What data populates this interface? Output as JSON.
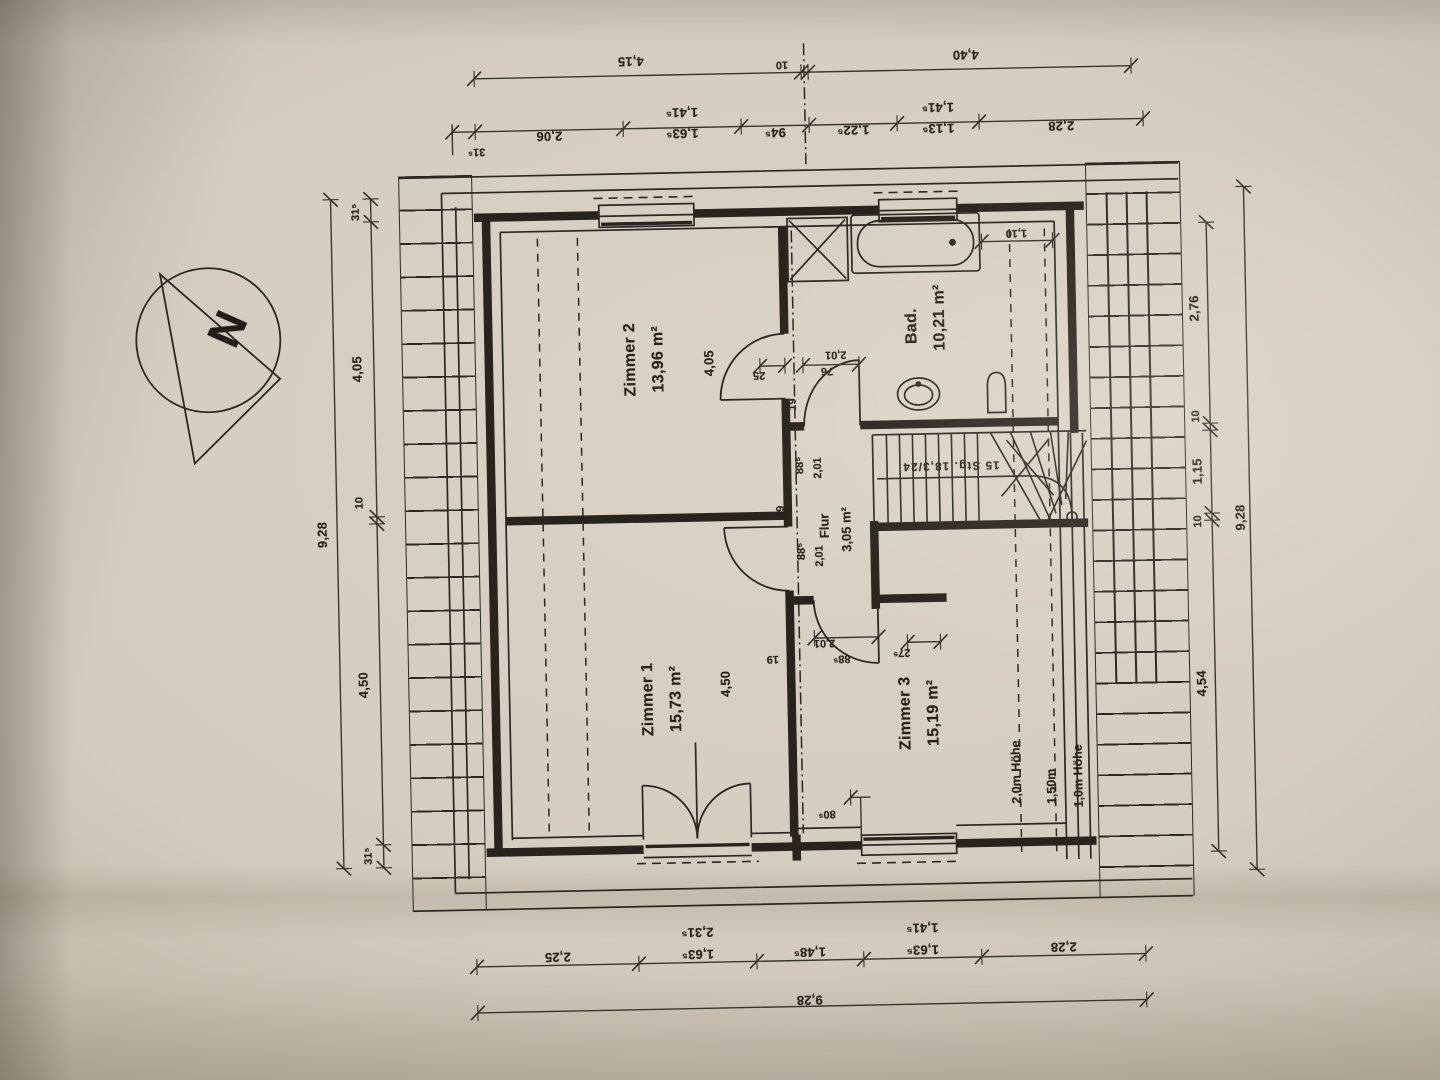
{
  "document_type": "Obergeschoss Grundriss (floor plan photo)",
  "compass": {
    "label": "N"
  },
  "rooms": [
    {
      "name": "Zimmer 1",
      "area": "15,73 m²"
    },
    {
      "name": "Zimmer 2",
      "area": "13,96 m²"
    },
    {
      "name": "Zimmer 3",
      "area": "15,19 m²"
    },
    {
      "name": "Bad.",
      "area": "10,21 m²"
    },
    {
      "name": "Flur",
      "area": "3,05 m²"
    }
  ],
  "stairs": {
    "annotation": "15 Stg. 18,3/24"
  },
  "roof_height_lines": [
    "2,0m Höhe",
    "1,50m",
    "1,0m Höhe"
  ],
  "dimensions": {
    "top_outer": [
      "4,15",
      "10",
      "4,40"
    ],
    "top_inner": [
      "31⁵",
      "2,06",
      "1,63⁵",
      "1,41⁵",
      "94⁵",
      "1,22⁵",
      "1,13⁵",
      "1,41⁵",
      "2,28"
    ],
    "left_inner": [
      "31⁵",
      "4,05",
      "10",
      "4,50",
      "31⁵"
    ],
    "left_outer": "9,28",
    "right_inner": [
      "2,76",
      "10",
      "1,15",
      "10",
      "4,54"
    ],
    "right_outer": "9,28",
    "bottom_inner": [
      "2,25",
      "2,31⁵",
      "1,63⁵",
      "1,48⁵",
      "1,41⁵",
      "1,63⁵",
      "2,28"
    ],
    "bottom_outer": "9,28",
    "room_depths": [
      "4,05",
      "4,50"
    ],
    "detail_dims": [
      "1,10",
      "2,01",
      "76",
      "25",
      "19",
      "88⁵",
      "2,01",
      "19",
      "88⁵",
      "2,01",
      "2,01",
      "88⁵",
      "19",
      "27⁵",
      "80⁵"
    ]
  },
  "labels": [
    {
      "t": "4,15",
      "x": 640,
      "y": 60,
      "r": 180,
      "c": "dim",
      "n": "dim-top-4-15"
    },
    {
      "t": "10",
      "x": 791,
      "y": 66,
      "r": 180,
      "c": "dimsm",
      "n": "dim-top-10"
    },
    {
      "t": "4,40",
      "x": 975,
      "y": 60,
      "r": 180,
      "c": "dim",
      "n": "dim-top-4-40"
    },
    {
      "t": "31⁵",
      "x": 484,
      "y": 147,
      "r": 180,
      "c": "dimsm",
      "n": "dim-top-31-5"
    },
    {
      "t": "2,06",
      "x": 557,
      "y": 133,
      "r": 180,
      "c": "dim",
      "n": "dim-top-2-06"
    },
    {
      "t": "1,41⁵",
      "x": 690,
      "y": 112,
      "r": 180,
      "c": "dim",
      "n": "dim-top-1-41-5-a"
    },
    {
      "t": "1,63⁵",
      "x": 690,
      "y": 133,
      "r": 180,
      "c": "dim",
      "n": "dim-top-1-63-5"
    },
    {
      "t": "94⁵",
      "x": 783,
      "y": 134,
      "r": 180,
      "c": "dim",
      "n": "dim-top-94-5"
    },
    {
      "t": "1,22⁵",
      "x": 861,
      "y": 133,
      "r": 180,
      "c": "dim",
      "n": "dim-top-1-22-5"
    },
    {
      "t": "1,41⁵",
      "x": 946,
      "y": 112,
      "r": 180,
      "c": "dim",
      "n": "dim-top-1-41-5-b"
    },
    {
      "t": "1,13⁵",
      "x": 946,
      "y": 133,
      "r": 180,
      "c": "dim",
      "n": "dim-top-1-13-5"
    },
    {
      "t": "2,28",
      "x": 1069,
      "y": 133,
      "r": 180,
      "c": "dim",
      "n": "dim-top-2-28"
    },
    {
      "t": "9,28",
      "x": 322,
      "y": 527,
      "r": -90,
      "c": "dim",
      "n": "dim-left-9-28"
    },
    {
      "t": "31⁵",
      "x": 362,
      "y": 205,
      "r": -90,
      "c": "dimsm",
      "n": "dim-left-31-5-top"
    },
    {
      "t": "4,05",
      "x": 360,
      "y": 362,
      "r": -90,
      "c": "dim",
      "n": "dim-left-4-05"
    },
    {
      "t": "10",
      "x": 360,
      "y": 496,
      "r": -90,
      "c": "dimsm",
      "n": "dim-left-10"
    },
    {
      "t": "4,50",
      "x": 360,
      "y": 678,
      "r": -90,
      "c": "dim",
      "n": "dim-left-4-50"
    },
    {
      "t": "31⁵",
      "x": 362,
      "y": 849,
      "r": -90,
      "c": "dimsm",
      "n": "dim-left-31-5-bottom"
    },
    {
      "t": "2,76",
      "x": 1198,
      "y": 318,
      "r": -90,
      "c": "dim",
      "n": "dim-right-2-76"
    },
    {
      "t": "10",
      "x": 1198,
      "y": 426,
      "r": -90,
      "c": "dimsm",
      "n": "dim-right-10-a"
    },
    {
      "t": "1,15",
      "x": 1198,
      "y": 481,
      "r": -90,
      "c": "dim",
      "n": "dim-right-1-15"
    },
    {
      "t": "10",
      "x": 1198,
      "y": 531,
      "r": -90,
      "c": "dimsm",
      "n": "dim-right-10-b"
    },
    {
      "t": "4,54",
      "x": 1198,
      "y": 693,
      "r": -90,
      "c": "dim",
      "n": "dim-right-4-54"
    },
    {
      "t": "9,28",
      "x": 1240,
      "y": 528,
      "r": -90,
      "c": "dim",
      "n": "dim-right-9-28"
    },
    {
      "t": "2,25",
      "x": 549,
      "y": 954,
      "r": 180,
      "c": "dim",
      "n": "dim-bottom-2-25"
    },
    {
      "t": "2,31⁵",
      "x": 689,
      "y": 932,
      "r": 180,
      "c": "dim",
      "n": "dim-bottom-2-31-5"
    },
    {
      "t": "1,63⁵",
      "x": 689,
      "y": 954,
      "r": 180,
      "c": "dim",
      "n": "dim-bottom-1-63-5-a"
    },
    {
      "t": "1,48⁵",
      "x": 801,
      "y": 954,
      "r": 180,
      "c": "dim",
      "n": "dim-bottom-1-48-5"
    },
    {
      "t": "1,41⁵",
      "x": 914,
      "y": 932,
      "r": 180,
      "c": "dim",
      "n": "dim-bottom-1-41-5"
    },
    {
      "t": "1,63⁵",
      "x": 914,
      "y": 954,
      "r": 180,
      "c": "dim",
      "n": "dim-bottom-1-63-5-b"
    },
    {
      "t": "2,28",
      "x": 1055,
      "y": 954,
      "r": 180,
      "c": "dim",
      "n": "dim-bottom-2-28"
    },
    {
      "t": "9,28",
      "x": 800,
      "y": 1002,
      "r": 180,
      "c": "dim",
      "n": "dim-bottom-9-28"
    },
    {
      "t": "Zimmer 2",
      "x": 634,
      "y": 358,
      "r": -90,
      "c": "room",
      "n": "room-label-zimmer-2"
    },
    {
      "t": "13,96 m²",
      "x": 662,
      "y": 358,
      "r": -90,
      "c": "room",
      "n": "area-label-zimmer-2"
    },
    {
      "t": "Zimmer 1",
      "x": 645,
      "y": 698,
      "r": -90,
      "c": "room",
      "n": "room-label-zimmer-1"
    },
    {
      "t": "15,73 m²",
      "x": 673,
      "y": 698,
      "r": -90,
      "c": "room",
      "n": "area-label-zimmer-1"
    },
    {
      "t": "Zimmer 3",
      "x": 902,
      "y": 717,
      "r": -90,
      "c": "room",
      "n": "room-label-zimmer-3"
    },
    {
      "t": "15,19 m²",
      "x": 930,
      "y": 717,
      "r": -90,
      "c": "room",
      "n": "area-label-zimmer-3"
    },
    {
      "t": "Bad.",
      "x": 916,
      "y": 330,
      "r": -90,
      "c": "room",
      "n": "room-label-bad"
    },
    {
      "t": "10,21 m²",
      "x": 944,
      "y": 322,
      "r": -90,
      "c": "room",
      "n": "area-label-bad"
    },
    {
      "t": "Flur",
      "x": 824,
      "y": 528,
      "r": -90,
      "c": "roomsm",
      "n": "room-label-flur"
    },
    {
      "t": "3,05 m²",
      "x": 846,
      "y": 532,
      "r": -90,
      "c": "roomsm",
      "n": "area-label-flur"
    },
    {
      "t": "4,05",
      "x": 712,
      "y": 363,
      "r": -90,
      "c": "dim",
      "n": "dim-room-4-05"
    },
    {
      "t": "4,50",
      "x": 722,
      "y": 684,
      "r": -90,
      "c": "dim",
      "n": "dim-room-4-50"
    },
    {
      "t": "1,10",
      "x": 1022,
      "y": 239,
      "r": 180,
      "c": "dimsm",
      "n": "dim-tub-1-10"
    },
    {
      "t": "2,01",
      "x": 839,
      "y": 357,
      "r": 180,
      "c": "dimsm",
      "n": "dim-baddoor-2-01"
    },
    {
      "t": "76",
      "x": 830,
      "y": 373,
      "r": 180,
      "c": "dimsm",
      "n": "dim-baddoor-76"
    },
    {
      "t": "25",
      "x": 762,
      "y": 376,
      "r": 180,
      "c": "dimsm",
      "n": "dim-wall-25"
    },
    {
      "t": "19",
      "x": 795,
      "y": 406,
      "r": -90,
      "c": "dimsm",
      "n": "dim-wall-19-a"
    },
    {
      "t": "88⁵",
      "x": 801,
      "y": 467,
      "r": -90,
      "c": "dimsm",
      "n": "dim-z2door-88-5"
    },
    {
      "t": "2,01",
      "x": 819,
      "y": 470,
      "r": -90,
      "c": "dimsm",
      "n": "dim-z2door-2-01"
    },
    {
      "t": "19",
      "x": 781,
      "y": 513,
      "r": -90,
      "c": "dimsm",
      "n": "dim-wall-19-b"
    },
    {
      "t": "88⁵",
      "x": 801,
      "y": 553,
      "r": -90,
      "c": "dimsm",
      "n": "dim-z1door-88-5"
    },
    {
      "t": "2,01",
      "x": 819,
      "y": 558,
      "r": -90,
      "c": "dimsm",
      "n": "dim-z1door-2-01"
    },
    {
      "t": "2,01",
      "x": 822,
      "y": 645,
      "r": 180,
      "c": "dimsm",
      "n": "dim-z3door-2-01"
    },
    {
      "t": "88⁵",
      "x": 839,
      "y": 661,
      "r": 180,
      "c": "dimsm",
      "n": "dim-z3door-88-5"
    },
    {
      "t": "19",
      "x": 770,
      "y": 660,
      "r": 180,
      "c": "dimsm",
      "n": "dim-wall-19-c"
    },
    {
      "t": "27⁵",
      "x": 899,
      "y": 656,
      "r": 180,
      "c": "dimsm",
      "n": "dim-wall-27-5"
    },
    {
      "t": "80⁵",
      "x": 821,
      "y": 816,
      "r": 180,
      "c": "dimsm",
      "n": "dim-window-80-5"
    },
    {
      "t": "15 Stg. 18,3/24",
      "x": 952,
      "y": 470,
      "r": 180,
      "c": "stair",
      "n": "stair-annotation"
    },
    {
      "t": "2,0m Höhe",
      "x": 1011,
      "y": 778,
      "r": -90,
      "c": "ht",
      "n": "height-line-2-0m"
    },
    {
      "t": "1,50m",
      "x": 1046,
      "y": 793,
      "r": -90,
      "c": "ht",
      "n": "height-line-1-50m"
    },
    {
      "t": "1,0m Höhe",
      "x": 1073,
      "y": 783,
      "r": -90,
      "c": "ht",
      "n": "height-line-1-0m"
    },
    {
      "t": "N",
      "x": 231,
      "y": 319,
      "r": -65,
      "c": "north",
      "n": "north-letter"
    }
  ]
}
